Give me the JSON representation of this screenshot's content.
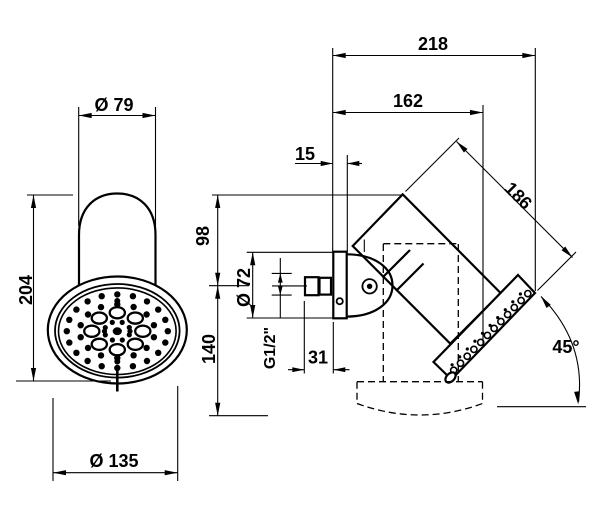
{
  "drawing_title": "shower-head-technical-drawing",
  "colors": {
    "background": "#ffffff",
    "line": "#000000"
  },
  "views": {
    "front": {
      "dim_top_diameter": "Ø 79",
      "dim_total_height": "204",
      "dim_face_diameter": "Ø 135"
    },
    "side": {
      "dim_wall_to_outer_corner": "218",
      "dim_wall_to_face": "162",
      "dim_plate_thickness": "15",
      "dim_body_diagonal_length": "186",
      "dim_top_to_pivot": "98",
      "dim_pivot_to_bottom": "140",
      "dim_plate_diameter": "Ø 72",
      "dim_thread": "G1/2\"",
      "dim_thread_protrusion": "31",
      "dim_tilt_angle": "45°"
    }
  }
}
